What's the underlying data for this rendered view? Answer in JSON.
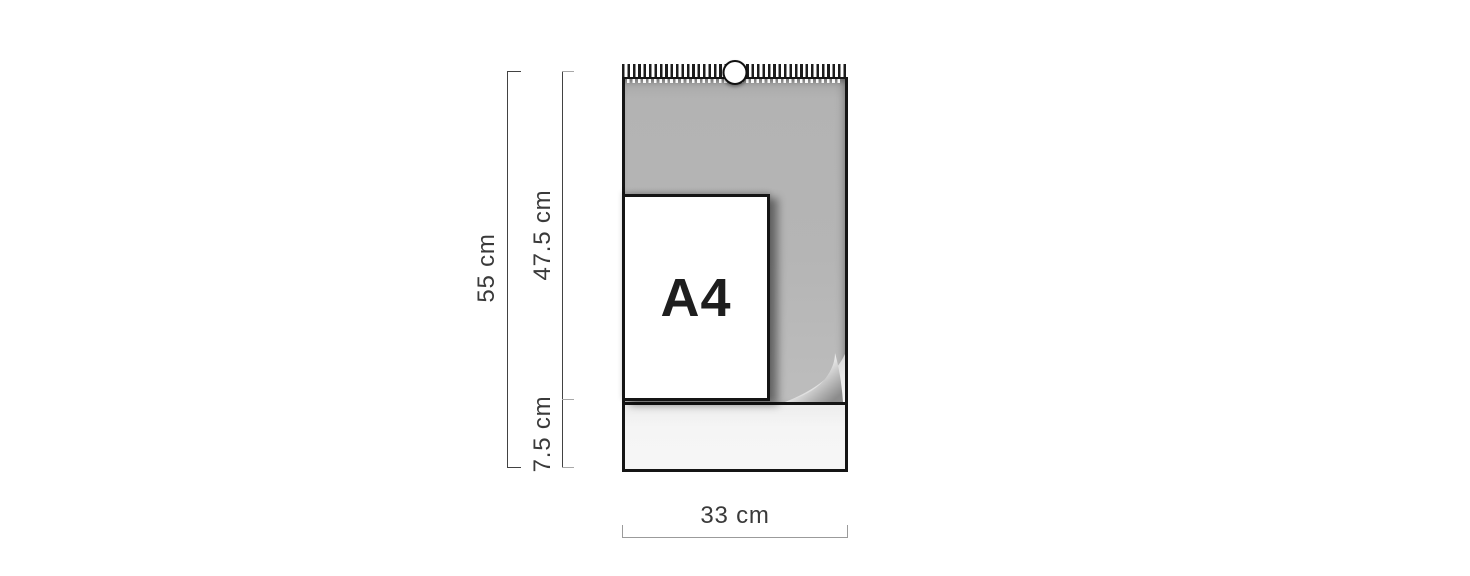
{
  "page": {
    "background_color": "#ffffff"
  },
  "diagram": {
    "dimension_labels": {
      "total_height": "55 cm",
      "upper_height": "47.5 cm",
      "lower_height": "7.5 cm",
      "width": "33 cm"
    },
    "calendar": {
      "paper_size_label": "A4"
    },
    "icons": {
      "hanger_hole": "hanger-hole-icon",
      "spiral_binding": "spiral-binding",
      "page_curl": "page-curl-icon"
    },
    "colors": {
      "calendar_page_gray": "#b5b5b5",
      "footer_strip": "#f4f4f4",
      "outline_black": "#151515",
      "a4_sheet_white": "#ffffff",
      "dimension_line_dark": "#424242",
      "dimension_cap_light": "#a8a8a8",
      "dimension_line_light": "#9b9b9b",
      "label_text": "#3a3a3a"
    }
  }
}
